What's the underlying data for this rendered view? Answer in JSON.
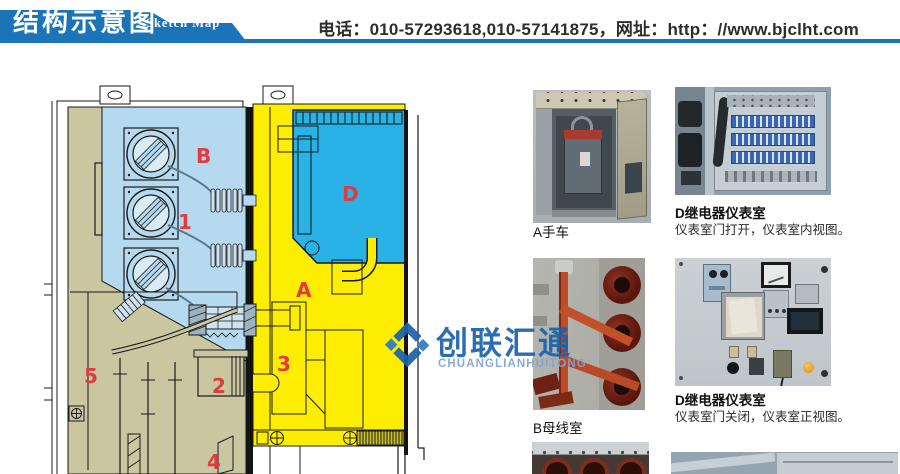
{
  "header": {
    "title_cn": "结构示意图",
    "title_en": "Sketch Map",
    "contact": "电话：010-57293618,010-57141875，网址：http：//www.bjclht.com"
  },
  "colors": {
    "header_blue": "#1c74b8",
    "logo_blue": "#1a63ae",
    "logo_light_blue": "#7fa6d4"
  },
  "diagram": {
    "labels": {
      "b": "B",
      "one": "1",
      "d": "D",
      "a": "A",
      "two": "2",
      "three": "3",
      "five": "5",
      "four": "4"
    },
    "region_colors": {
      "compartment_b": "#b5d9ee",
      "compartment_d": "#29b2e5",
      "compartment_a": "#fdee00",
      "mechanism": "#c9c6a0",
      "label_red": "#e03b40"
    }
  },
  "watermark": {
    "name_cn": "创联汇通",
    "name_en": "CHUANGLIANHUITONG"
  },
  "photo_panel": {
    "photos": [
      {
        "caption": "A手车"
      },
      {
        "caption": "D继电器仪表室",
        "subcaption": "仪表室门打开，仪表室内视图。"
      },
      {
        "caption": "B母线室"
      },
      {
        "caption": "D继电器仪表室",
        "subcaption": "仪表室门关闭，仪表室正视图。"
      }
    ]
  }
}
